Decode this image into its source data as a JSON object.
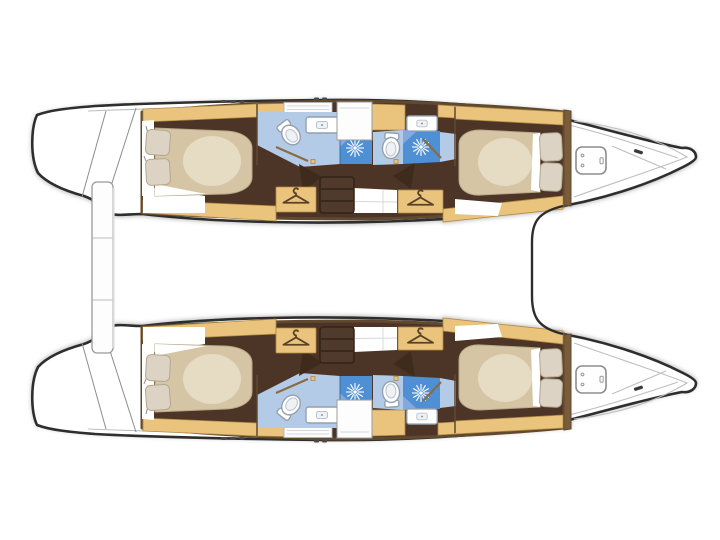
{
  "meta": {
    "type": "boat-floor-plan",
    "subject": "catamaran interior layout, top-down view",
    "hulls": 2,
    "orientation": "bows-right-sterns-left"
  },
  "counts": {
    "double_berth_cabins": 4,
    "pillows": 8,
    "heads_bathrooms": 4,
    "showers": 4,
    "toilets": 4,
    "sinks": 4,
    "hanging_lockers": 4,
    "companionway_steps": 2,
    "bow_deck_hatches": 2,
    "stern_swim_platforms": 2
  },
  "icons": {
    "shower": "starburst-jet-icon",
    "hanging_locker": "clothes-hanger-icon",
    "toilet": "toilet-top-view-icon",
    "sink": "basin-icon",
    "bow_locker": "deck-hatch-icon"
  },
  "colors": {
    "background": "#ffffff",
    "hull_fill": "#ffffff",
    "hull_outline": "#2e2e2e",
    "deck_line": "#bfbfbf",
    "detail_gray": "#8d8d8d",
    "frame_brown": "#60492e",
    "wood": "#eac47d",
    "wood_edge": "#b08a44",
    "floor_brown": "#4c3526",
    "floor_dark": "#3f2b1c",
    "step_brown": "#4f3a2b",
    "bed_beige": "#d5c5a5",
    "bed_highlight": "#f0e7d3",
    "pillow": "#dcd3c4",
    "pillow_edge": "#b3a890",
    "bath_blue_light": "#b4cbe8",
    "bath_blue_mid": "#84a9dd",
    "bath_blue_deep": "#4f8fd4",
    "fixture_white": "#ffffff",
    "fixture_stroke": "#93a0ae",
    "door_line": "#8a6b42"
  }
}
